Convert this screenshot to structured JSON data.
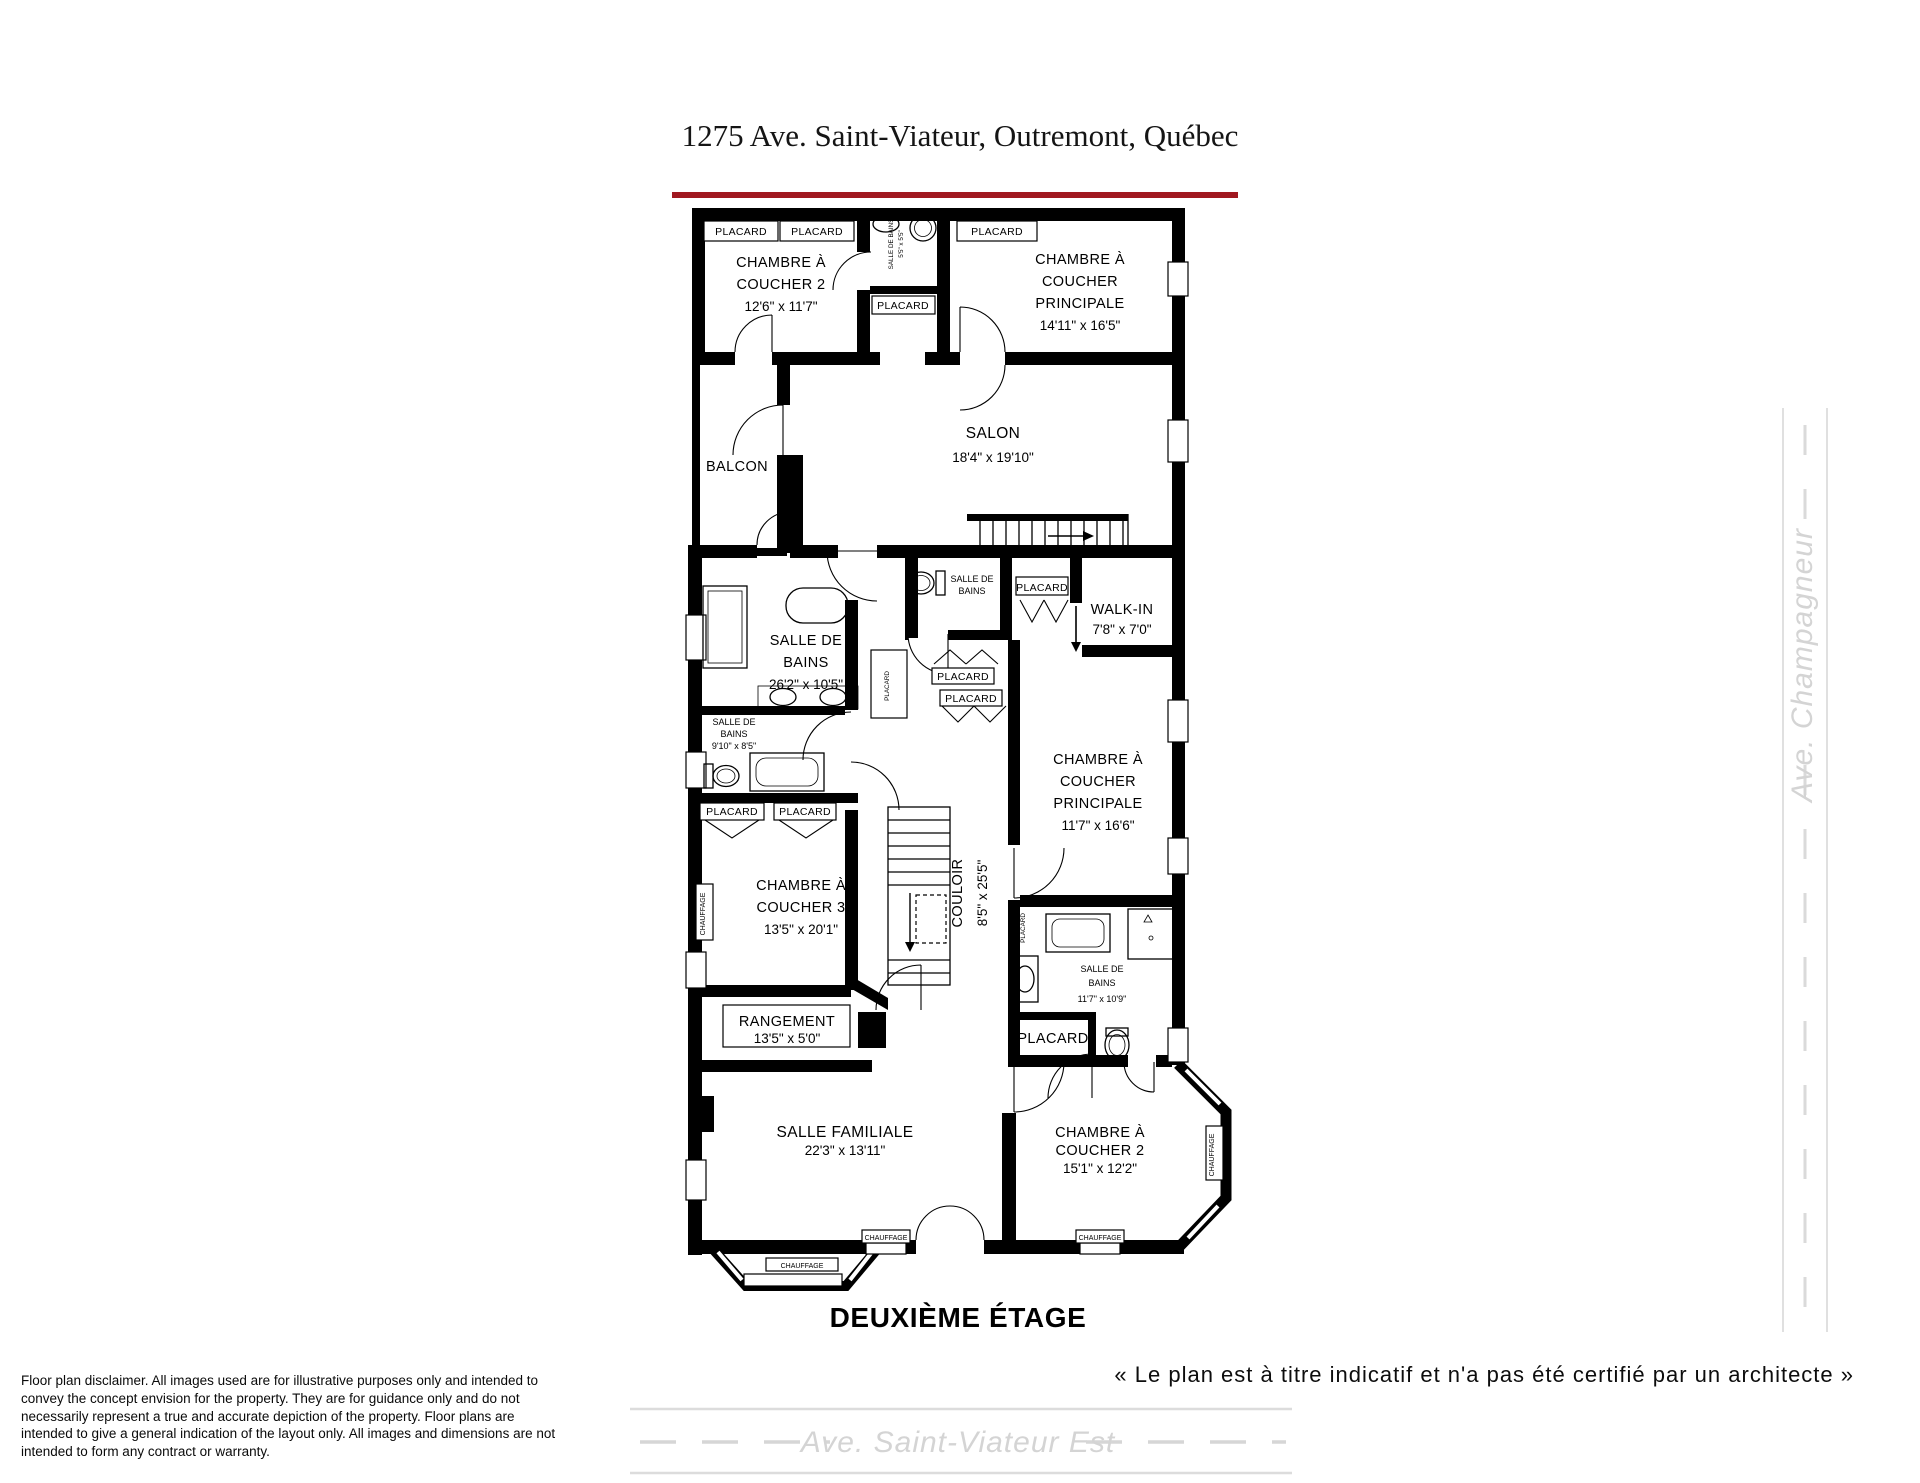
{
  "header": {
    "title": "1275 Ave. Saint-Viateur, Outremont, Québec",
    "accent_color": "#a01820"
  },
  "plan": {
    "floor_label": "DEUXIÈME ÉTAGE",
    "labels": {
      "placard": "PLACARD",
      "chauffage": "CHAUFFAGE"
    },
    "rooms": {
      "chambre2_haut": {
        "l1": "CHAMBRE À",
        "l2": "COUCHER 2",
        "dims": "12'6\" x 11'7\""
      },
      "sdb_haut": {
        "name": "SALLE DE BAINS",
        "dims": "5'5\" x 5'5\""
      },
      "chambre_principale_haut": {
        "l1": "CHAMBRE À",
        "l2": "COUCHER",
        "l3": "PRINCIPALE",
        "dims": "14'11\" x 16'5\""
      },
      "balcon": {
        "name": "BALCON"
      },
      "salon": {
        "name": "SALON",
        "dims": "18'4\" x 19'10\""
      },
      "sdb_principale": {
        "l1": "SALLE DE",
        "l2": "BAINS",
        "dims": "26'2\" x 10'5\""
      },
      "sdb_toilette": {
        "l1": "SALLE DE",
        "l2": "BAINS"
      },
      "walk_in": {
        "name": "WALK-IN",
        "dims": "7'8\" x 7'0\""
      },
      "sdb_2": {
        "l1": "SALLE DE",
        "l2": "BAINS",
        "dims": "9'10\" x 8'5\""
      },
      "chambre_principale_bas": {
        "l1": "CHAMBRE À",
        "l2": "COUCHER",
        "l3": "PRINCIPALE",
        "dims": "11'7\" x 16'6\""
      },
      "chambre3": {
        "l1": "CHAMBRE À",
        "l2": "COUCHER 3",
        "dims": "13'5\" x 20'1\""
      },
      "couloir": {
        "name": "COULOIR",
        "dims": "8'5\" x 25'5\""
      },
      "rangement": {
        "name": "RANGEMENT",
        "dims": "13'5\" x 5'0\""
      },
      "sdb_3": {
        "l1": "SALLE DE",
        "l2": "BAINS",
        "dims": "11'7\" x 10'9\""
      },
      "salle_familiale": {
        "name": "SALLE FAMILIALE",
        "dims": "22'3\" x 13'11\""
      },
      "chambre2_bas": {
        "l1": "CHAMBRE À",
        "l2": "COUCHER 2",
        "dims": "15'1\" x 12'2\""
      }
    }
  },
  "streets": {
    "bottom": "Ave. Saint-Viateur Est",
    "right": "Ave. Champagneur"
  },
  "footer": {
    "quote": "« Le plan est à titre indicatif et n'a pas été certifié par un architecte »",
    "disclaimer": "Floor plan disclaimer. All images used are for illustrative purposes only and intended to convey the concept envision for the property. They are for guidance only and do not necessarily represent a true and accurate depiction of the property. Floor plans are intended to give a general indication of the layout only. All images and dimensions are not intended to form any contract or warranty."
  }
}
